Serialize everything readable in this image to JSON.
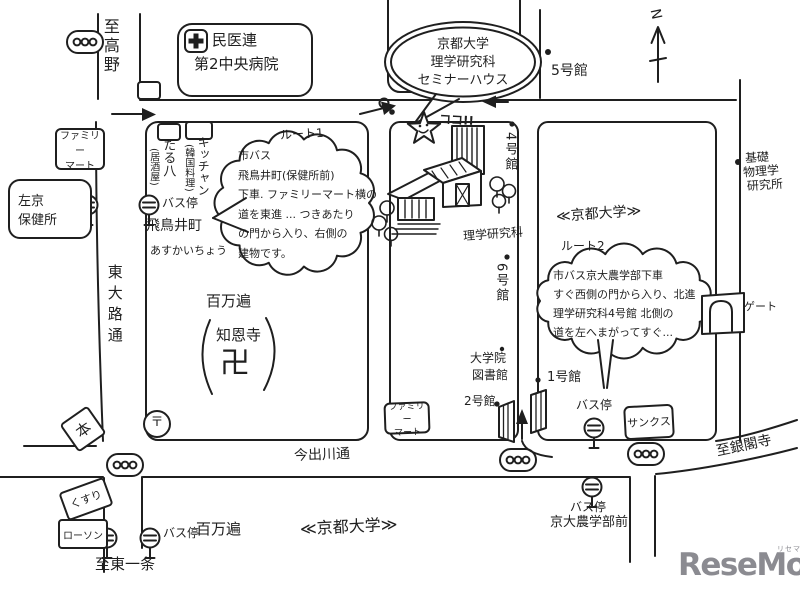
{
  "colors": {
    "ink": "#1f1f1f",
    "paper": "#ffffff",
    "logo_gray": "#8b8b91"
  },
  "compass": {
    "north_label": "N"
  },
  "edge_labels": {
    "to_takano": "至高野",
    "to_higashi_ichijo": "至東一条",
    "to_ginkakuji": "至銀閣寺"
  },
  "streets": {
    "higashioji": "東大路通",
    "imadegawa": "今出川通"
  },
  "university_labels": {
    "right": "≪京都大学≫",
    "bottom": "≪京都大学≫"
  },
  "balloon": {
    "lines": [
      "京都大学",
      "理学研究科",
      "セミナーハウス"
    ]
  },
  "here_marker": {
    "label": "ココ!!"
  },
  "routes": {
    "route1": {
      "title": "ルート1",
      "lines": [
        "市バス",
        "飛鳥井町(保健所前)",
        "下車. ファミリーマート横の",
        "道を東進 ... つきあたり",
        "の門から入り、右側の",
        "建物です。"
      ]
    },
    "route2": {
      "title": "ルート2",
      "lines": [
        "市バス京大農学部下車",
        "すぐ西側の門から入り、北進",
        "理学研究科4号館 北側の",
        "道を左へまがってすぐ..."
      ]
    }
  },
  "places": {
    "hospital": {
      "lines": [
        "民医連",
        "第2中央病院"
      ]
    },
    "famima_top": {
      "lines": [
        "ファミリー",
        "マート"
      ]
    },
    "hokenjo": {
      "lines": [
        "左京",
        "保健所"
      ]
    },
    "taruhachi": {
      "name": "たる八",
      "note": "(居酒屋)"
    },
    "kitchen": {
      "name": "キッチャン",
      "note": "(韓国料理)"
    },
    "bus_stop_asukai": {
      "label": "バス停",
      "name": "飛鳥井町",
      "kana": "あすかいちょう"
    },
    "temple": {
      "area": "百万遍",
      "name": "知恩寺",
      "manji": "卍"
    },
    "post_office": {
      "symbol": "〒"
    },
    "book_store": {
      "label": "本"
    },
    "pharmacy": {
      "label": "くすり"
    },
    "lawson": {
      "label": "ローソン"
    },
    "bus_stop_hyakumanben": {
      "label": "バス停",
      "name": "百万遍"
    },
    "bus_stop_nogakubu": {
      "label": "バス停",
      "name": "京大農学部前"
    },
    "bus_stop_east": {
      "label": "バス停"
    },
    "sunkus": {
      "label": "サンクス"
    },
    "famima_south": {
      "lines": [
        "ファミリー",
        "マート"
      ]
    },
    "gate": {
      "label": "ゲート"
    },
    "kiso_physics": {
      "lines": [
        "基礎",
        "物理学",
        "研究所"
      ]
    },
    "bldg5": {
      "label": "5号館"
    },
    "bldg4": {
      "label": "4号館"
    },
    "rigaku": {
      "label": "理学研究科"
    },
    "bldg6": {
      "label": "6号館"
    },
    "grad_library": {
      "lines": [
        "大学院",
        "図書館"
      ]
    },
    "bldg2": {
      "label": "2号館"
    },
    "bldg1": {
      "label": "1号館"
    }
  },
  "logo": {
    "text": "ReseMom.",
    "ruby": "リセマム"
  }
}
